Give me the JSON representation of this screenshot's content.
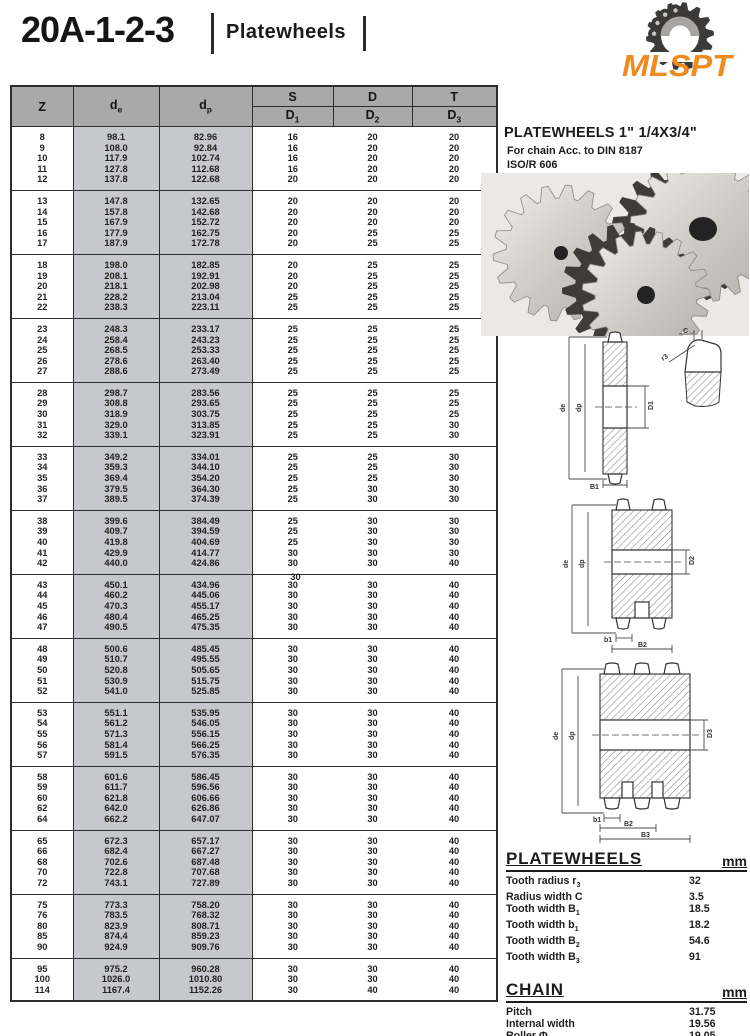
{
  "page": {
    "catalog_code": "20A-1-2-3",
    "title": "Platewheels",
    "logo_text": "MLSPT",
    "logo_color": "#ef8a1f"
  },
  "product": {
    "title": "PLATEWHEELS 1\" 1/4X3/4\"",
    "subtitle1": "For chain Acc. to DIN 8187",
    "subtitle2": "ISO/R 606"
  },
  "table": {
    "headers": {
      "z": "Z",
      "de_base": "d",
      "de_sub": "e",
      "dp_base": "d",
      "dp_sub": "p",
      "s": "S",
      "d": "D",
      "t": "T",
      "d1_base": "D",
      "d1_sub": "1",
      "d2_base": "D",
      "d2_sub": "2",
      "d3_base": "D",
      "d3_sub": "3"
    },
    "stray_value": "30",
    "groups": [
      [
        [
          "8",
          "98.1",
          "82.96",
          "16",
          "20",
          "20"
        ],
        [
          "9",
          "108.0",
          "92.84",
          "16",
          "20",
          "20"
        ],
        [
          "10",
          "117.9",
          "102.74",
          "16",
          "20",
          "20"
        ],
        [
          "11",
          "127.8",
          "112.68",
          "16",
          "20",
          "20"
        ],
        [
          "12",
          "137.8",
          "122.68",
          "20",
          "20",
          "20"
        ]
      ],
      [
        [
          "13",
          "147.8",
          "132.65",
          "20",
          "20",
          "20"
        ],
        [
          "14",
          "157.8",
          "142.68",
          "20",
          "20",
          "20"
        ],
        [
          "15",
          "167.9",
          "152.72",
          "20",
          "20",
          "20"
        ],
        [
          "16",
          "177.9",
          "162.75",
          "20",
          "25",
          "25"
        ],
        [
          "17",
          "187.9",
          "172.78",
          "20",
          "25",
          "25"
        ]
      ],
      [
        [
          "18",
          "198.0",
          "182.85",
          "20",
          "25",
          "25"
        ],
        [
          "19",
          "208.1",
          "192.91",
          "20",
          "25",
          "25"
        ],
        [
          "20",
          "218.1",
          "202.98",
          "20",
          "25",
          "25"
        ],
        [
          "21",
          "228.2",
          "213.04",
          "25",
          "25",
          "25"
        ],
        [
          "22",
          "238.3",
          "223.11",
          "25",
          "25",
          "25"
        ]
      ],
      [
        [
          "23",
          "248.3",
          "233.17",
          "25",
          "25",
          "25"
        ],
        [
          "24",
          "258.4",
          "243.23",
          "25",
          "25",
          "25"
        ],
        [
          "25",
          "268.5",
          "253.33",
          "25",
          "25",
          "25"
        ],
        [
          "26",
          "278.6",
          "263.40",
          "25",
          "25",
          "25"
        ],
        [
          "27",
          "288.6",
          "273.49",
          "25",
          "25",
          "25"
        ]
      ],
      [
        [
          "28",
          "298.7",
          "283.56",
          "25",
          "25",
          "25"
        ],
        [
          "29",
          "308.8",
          "293.65",
          "25",
          "25",
          "25"
        ],
        [
          "30",
          "318.9",
          "303.75",
          "25",
          "25",
          "25"
        ],
        [
          "31",
          "329.0",
          "313.85",
          "25",
          "25",
          "30"
        ],
        [
          "32",
          "339.1",
          "323.91",
          "25",
          "25",
          "30"
        ]
      ],
      [
        [
          "33",
          "349.2",
          "334.01",
          "25",
          "25",
          "30"
        ],
        [
          "34",
          "359.3",
          "344.10",
          "25",
          "25",
          "30"
        ],
        [
          "35",
          "369.4",
          "354.20",
          "25",
          "25",
          "30"
        ],
        [
          "36",
          "379.5",
          "364.30",
          "25",
          "30",
          "30"
        ],
        [
          "37",
          "389.5",
          "374.39",
          "25",
          "30",
          "30"
        ]
      ],
      [
        [
          "38",
          "399.6",
          "384.49",
          "25",
          "30",
          "30"
        ],
        [
          "39",
          "409.7",
          "394.59",
          "25",
          "30",
          "30"
        ],
        [
          "40",
          "419.8",
          "404.69",
          "25",
          "30",
          "30"
        ],
        [
          "41",
          "429.9",
          "414.77",
          "30",
          "30",
          "30"
        ],
        [
          "42",
          "440.0",
          "424.86",
          "30",
          "30",
          "40"
        ]
      ],
      [
        [
          "43",
          "450.1",
          "434.96",
          "30",
          "30",
          "40"
        ],
        [
          "44",
          "460.2",
          "445.06",
          "30",
          "30",
          "40"
        ],
        [
          "45",
          "470.3",
          "455.17",
          "30",
          "30",
          "40"
        ],
        [
          "46",
          "480.4",
          "465.25",
          "30",
          "30",
          "40"
        ],
        [
          "47",
          "490.5",
          "475.35",
          "30",
          "30",
          "40"
        ]
      ],
      [
        [
          "48",
          "500.6",
          "485.45",
          "30",
          "30",
          "40"
        ],
        [
          "49",
          "510.7",
          "495.55",
          "30",
          "30",
          "40"
        ],
        [
          "50",
          "520.8",
          "505.65",
          "30",
          "30",
          "40"
        ],
        [
          "51",
          "530.9",
          "515.75",
          "30",
          "30",
          "40"
        ],
        [
          "52",
          "541.0",
          "525.85",
          "30",
          "30",
          "40"
        ]
      ],
      [
        [
          "53",
          "551.1",
          "535.95",
          "30",
          "30",
          "40"
        ],
        [
          "54",
          "561.2",
          "546.05",
          "30",
          "30",
          "40"
        ],
        [
          "55",
          "571.3",
          "556.15",
          "30",
          "30",
          "40"
        ],
        [
          "56",
          "581.4",
          "566.25",
          "30",
          "30",
          "40"
        ],
        [
          "57",
          "591.5",
          "576.35",
          "30",
          "30",
          "40"
        ]
      ],
      [
        [
          "58",
          "601.6",
          "586.45",
          "30",
          "30",
          "40"
        ],
        [
          "59",
          "611.7",
          "596.56",
          "30",
          "30",
          "40"
        ],
        [
          "60",
          "621.8",
          "606.66",
          "30",
          "30",
          "40"
        ],
        [
          "62",
          "642.0",
          "626.86",
          "30",
          "30",
          "40"
        ],
        [
          "64",
          "662.2",
          "647.07",
          "30",
          "30",
          "40"
        ]
      ],
      [
        [
          "65",
          "672.3",
          "657.17",
          "30",
          "30",
          "40"
        ],
        [
          "66",
          "682.4",
          "667.27",
          "30",
          "30",
          "40"
        ],
        [
          "68",
          "702.6",
          "687.48",
          "30",
          "30",
          "40"
        ],
        [
          "70",
          "722.8",
          "707.68",
          "30",
          "30",
          "40"
        ],
        [
          "72",
          "743.1",
          "727.89",
          "30",
          "30",
          "40"
        ]
      ],
      [
        [
          "75",
          "773.3",
          "758.20",
          "30",
          "30",
          "40"
        ],
        [
          "76",
          "783.5",
          "768.32",
          "30",
          "30",
          "40"
        ],
        [
          "80",
          "823.9",
          "808.71",
          "30",
          "30",
          "40"
        ],
        [
          "85",
          "874.4",
          "859.23",
          "30",
          "30",
          "40"
        ],
        [
          "90",
          "924.9",
          "909.76",
          "30",
          "30",
          "40"
        ]
      ],
      [
        [
          "95",
          "975.2",
          "960.28",
          "30",
          "30",
          "40"
        ],
        [
          "100",
          "1026.0",
          "1010.80",
          "30",
          "30",
          "40"
        ],
        [
          "114",
          "1167.4",
          "1152.26",
          "30",
          "40",
          "40"
        ]
      ]
    ]
  },
  "drawings": {
    "single": {
      "de_label": "de",
      "dp_label": "dp",
      "bore_label": "D1",
      "width_label": "B1",
      "c_label": "C",
      "r_label": "r3"
    },
    "duplex": {
      "de_label": "de",
      "dp_label": "dp",
      "bore_label": "D2",
      "b1_label": "b1",
      "b2_label": "B2"
    },
    "triplex": {
      "de_label": "de",
      "dp_label": "dp",
      "bore_label": "D3",
      "b1_label": "b1",
      "b2_label": "B2",
      "b3_label": "B3"
    }
  },
  "specs": {
    "platewheels": {
      "title": "PLATEWHEELS",
      "unit": "mm",
      "rows": [
        {
          "label": "Tooth radius r",
          "sub": "3",
          "value": "32"
        },
        {
          "label": "Radius width C",
          "sub": "",
          "value": "3.5"
        },
        {
          "label": "Tooth width B",
          "sub": "1",
          "value": "18.5"
        },
        {
          "label": "Tooth width b",
          "sub": "1",
          "value": "18.2"
        },
        {
          "label": "Tooth width B",
          "sub": "2",
          "value": "54.6"
        },
        {
          "label": "Tooth width B",
          "sub": "3",
          "value": "91"
        }
      ]
    },
    "chain": {
      "title": "CHAIN",
      "unit": "mm",
      "rows": [
        {
          "label": "Pitch",
          "sub": "",
          "value": "31.75"
        },
        {
          "label": "Internal width",
          "sub": "",
          "value": "19.56"
        },
        {
          "label": "Roller Φ",
          "sub": "",
          "value": "19.05"
        }
      ]
    }
  }
}
